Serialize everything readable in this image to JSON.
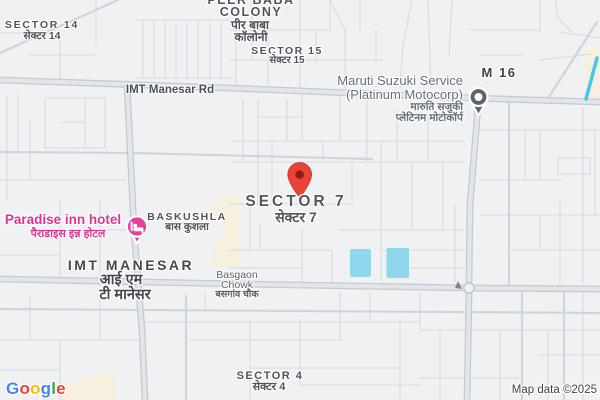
{
  "map": {
    "provider": "Google",
    "attribution": "Map data ©2025",
    "logo_letters": [
      {
        "ch": "G",
        "style": "color:#4285F4"
      },
      {
        "ch": "o",
        "style": "color:#EA4335"
      },
      {
        "ch": "o",
        "style": "color:#FBBC05"
      },
      {
        "ch": "g",
        "style": "color:#4285F4"
      },
      {
        "ch": "l",
        "style": "color:#34A853"
      },
      {
        "ch": "e",
        "style": "color:#EA4335"
      }
    ],
    "labels": {
      "sector14": {
        "en": "SECTOR 14",
        "hi": "सेक्टर 14"
      },
      "peer_baba_colony": {
        "en1": "PEER BABA",
        "en2": "COLONY",
        "hi1": "पीर बाबा",
        "hi2": "कॉलोनी"
      },
      "sector15": {
        "en": "SECTOR 15",
        "hi": "सेक्टर 15"
      },
      "imt_manesar_rd": {
        "en": "IMT Manesar Rd"
      },
      "maruti_service": {
        "en1": "Maruti Suzuki Service",
        "en2": "(Platinum Motocorp)",
        "hi1": "मारुति सजुकी",
        "hi2": "प्लेटिनम मोटोकॉर्प"
      },
      "m16": {
        "en": "M 16"
      },
      "sector7": {
        "en": "SECTOR 7",
        "hi": "सेक्टर 7"
      },
      "paradise_hotel": {
        "en": "Paradise inn hotel",
        "hi": "पैराडाइस इन्न होटल"
      },
      "baskushla": {
        "en": "BASKUSHLA",
        "hi": "बास कुशला"
      },
      "imt_manesar": {
        "en": "IMT MANESAR",
        "hi1": "आई एम",
        "hi2": "टी मानेसर"
      },
      "basgaon_chowk": {
        "en1": "Basgaon",
        "en2": "Chowk",
        "hi": "बसगांव चौक"
      },
      "sector4": {
        "en": "SECTOR 4",
        "hi": "सेक्टर 4"
      }
    },
    "markers": {
      "destination": {
        "type": "red-pin",
        "at": "SECTOR 7"
      },
      "hotel": {
        "type": "lodging-pin",
        "at": "Paradise inn hotel"
      },
      "service": {
        "type": "poi-pin",
        "at": "Maruti Suzuki Service (Platinum Motocorp)"
      }
    },
    "colors": {
      "land": "#F0F1F3",
      "water": "#8FD7EA",
      "commercial_area": "#F7F0DE",
      "road_minor": "#D9DEE5",
      "road_major": "#C5CBD4",
      "pin_red": "#EA4335",
      "pin_red_dot": "#8D1E12",
      "poi_pink": "#E3429C",
      "poi_gray": "#5B636D",
      "label_text": "#4E545B"
    }
  }
}
